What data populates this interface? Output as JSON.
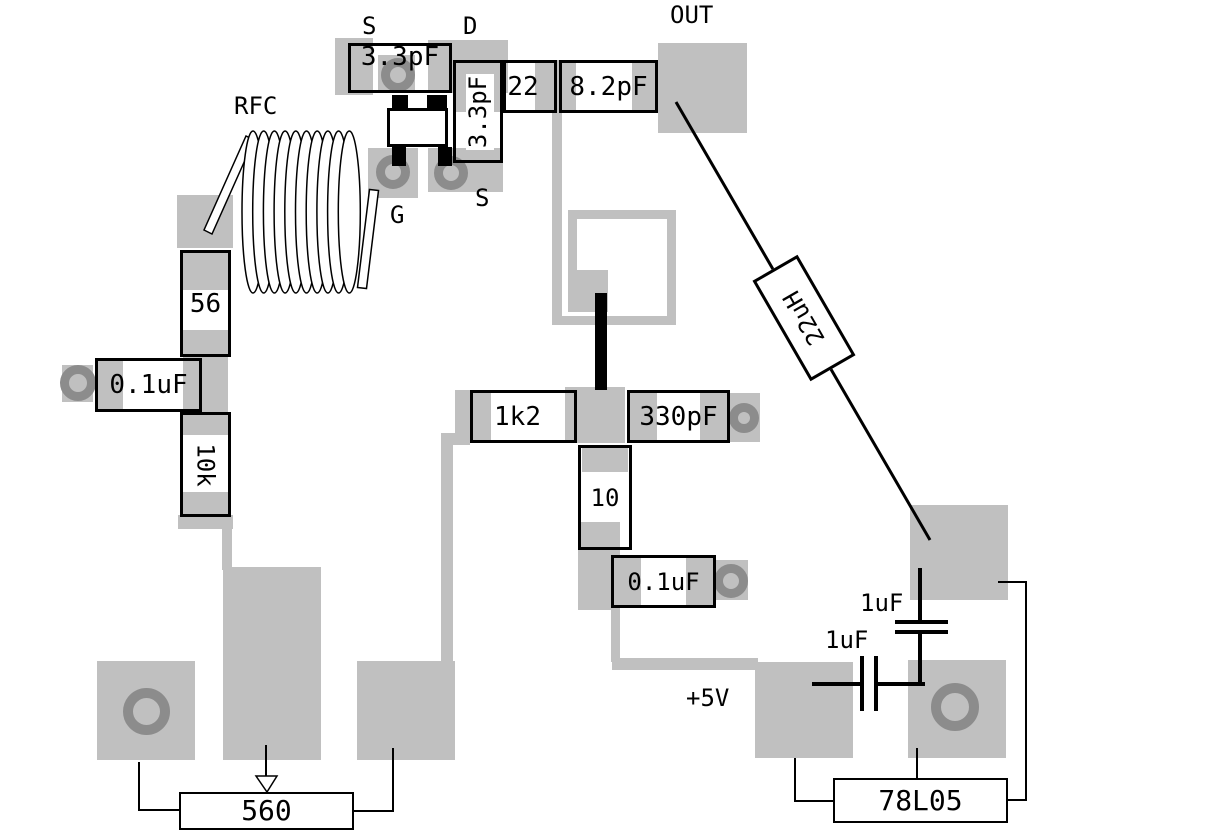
{
  "title": "RF amplifier PCB layout",
  "labels": {
    "source_top": "S",
    "drain": "D",
    "out": "OUT",
    "rfc": "RFC",
    "gate": "G",
    "source_bottom": "S",
    "plus5v": "+5V",
    "cap1uf_upper": "1uF",
    "cap1uf_lower": "1uF"
  },
  "components": {
    "cap_3p3_top": "3.3pF",
    "cap_3p3_vert": "3.3pF",
    "cap_22": "22",
    "cap_8p2": "8.2pF",
    "ind_22uh": "22uH",
    "res_56": "56",
    "cap_0p1_left": "0.1uF",
    "res_10k": "10k",
    "res_1k2": "1k2",
    "cap_330p": "330pF",
    "res_10": "10",
    "cap_0p1_mid": "0.1uF",
    "res_560": "560",
    "reg_78l05": "78L05"
  },
  "colors": {
    "pad_gray": "#c0c0c0",
    "via_ring": "#8c8c8c",
    "line_black": "#000000",
    "background": "#ffffff"
  }
}
